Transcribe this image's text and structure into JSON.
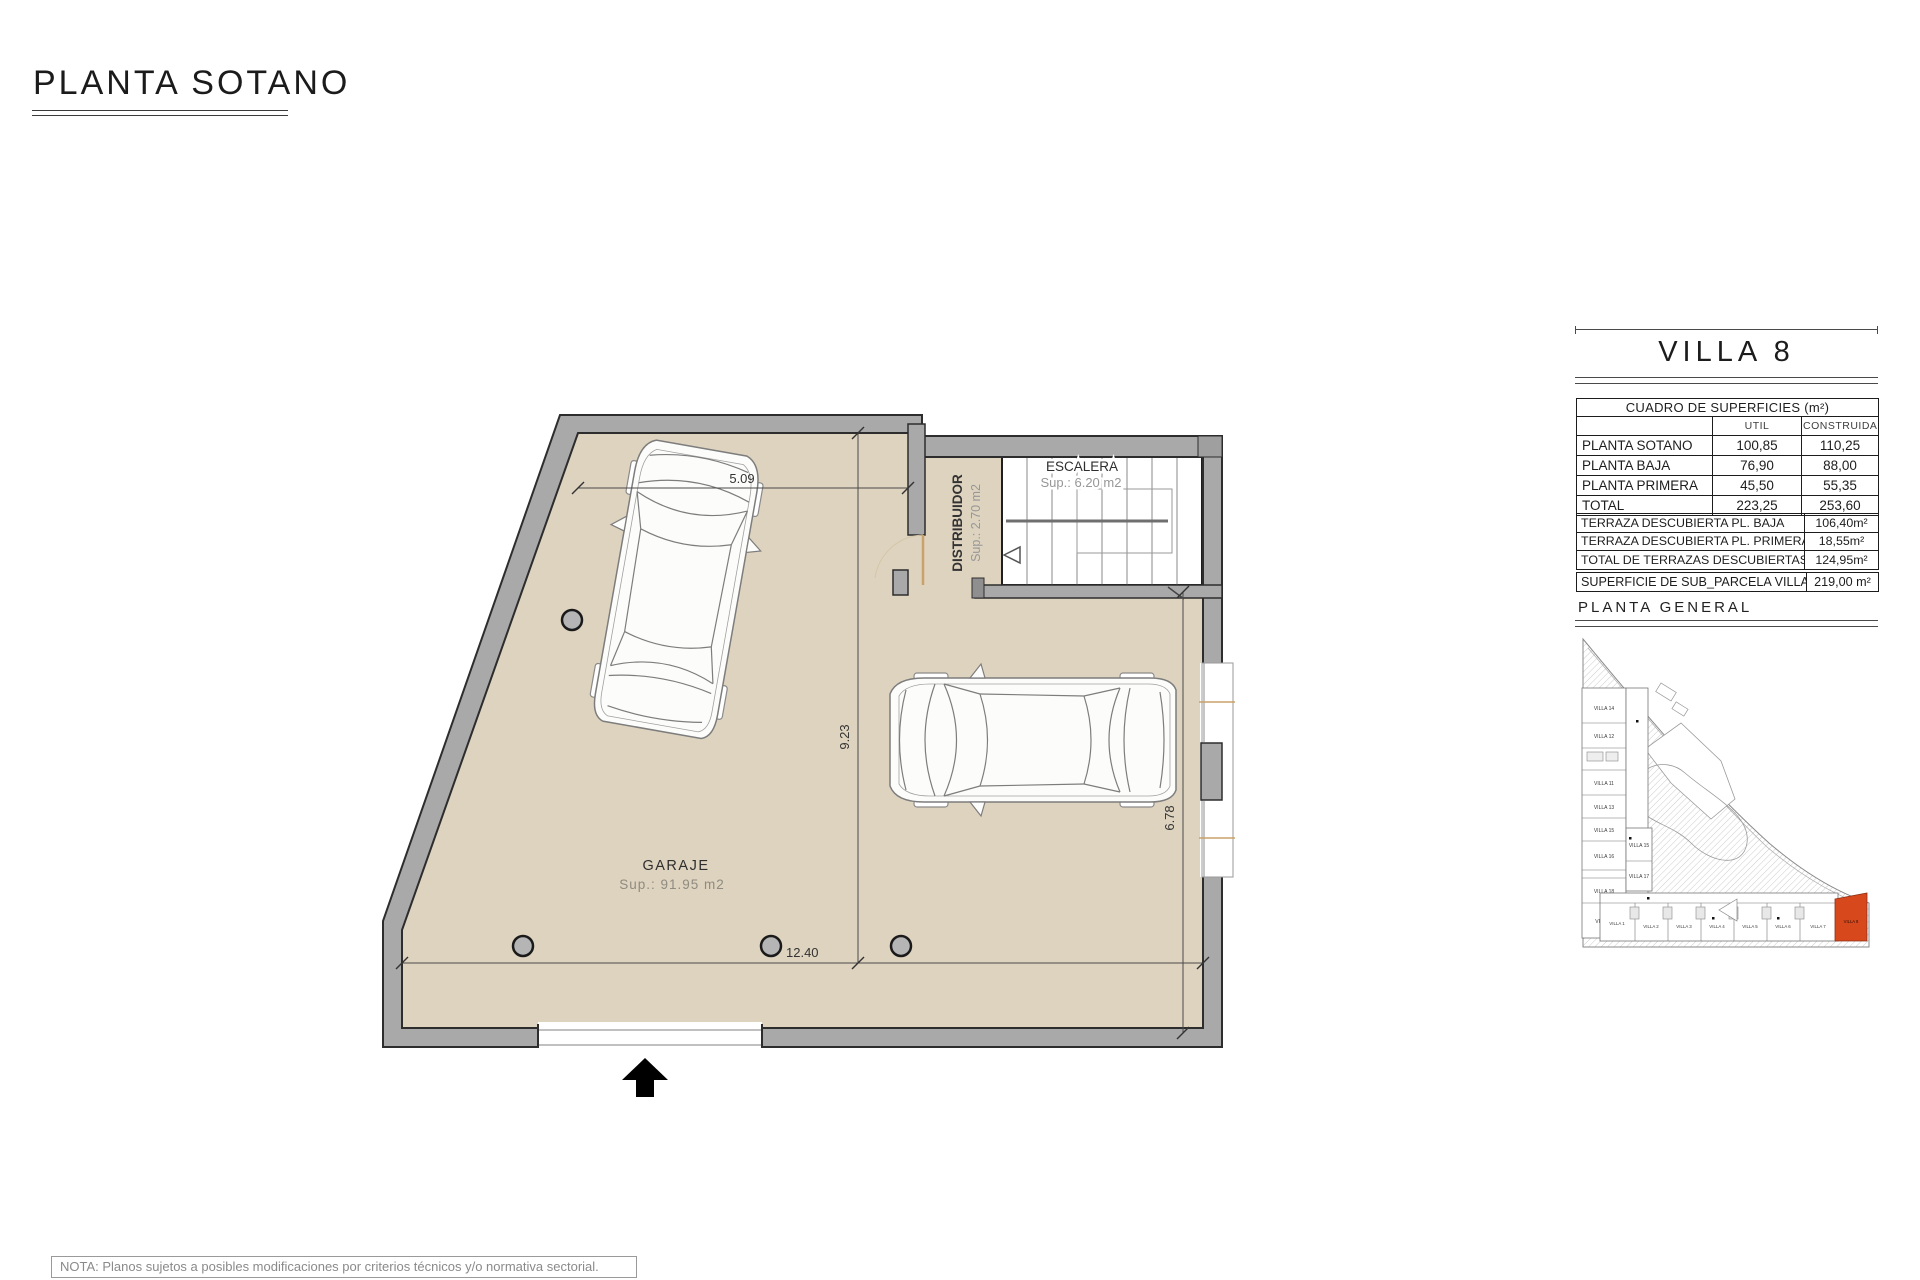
{
  "title": {
    "text": "PLANTA SOTANO"
  },
  "plan": {
    "garaje": {
      "name": "GARAJE",
      "sup": "Sup.: 91.95 m2"
    },
    "escalera": {
      "name": "ESCALERA",
      "sup": "Sup.: 6.20 m2"
    },
    "distribuidor": {
      "name": "DISTRIBUIDOR",
      "sup": "Sup.: 2.70 m2"
    },
    "dims": {
      "top": "5.09",
      "left": "9.23",
      "bottom": "12.40",
      "right": "6.78"
    }
  },
  "panel": {
    "villa": "VILLA 8",
    "cuadro": {
      "title": "CUADRO DE SUPERFICIES (m²)",
      "col_util": "UTIL",
      "col_construida": "CONSTRUIDA",
      "rows": [
        {
          "label": "PLANTA SOTANO",
          "util": "100,85",
          "construida": "110,25"
        },
        {
          "label": "PLANTA BAJA",
          "util": "76,90",
          "construida": "88,00"
        },
        {
          "label": "PLANTA PRIMERA",
          "util": "45,50",
          "construida": "55,35"
        },
        {
          "label": "TOTAL",
          "util": "223,25",
          "construida": "253,60"
        }
      ]
    },
    "terrazas": [
      {
        "label": "TERRAZA DESCUBIERTA PL. BAJA",
        "value": "106,40m²"
      },
      {
        "label": "TERRAZA DESCUBIERTA PL. PRIMERA",
        "value": "18,55m²"
      },
      {
        "label": "TOTAL DE TERRAZAS DESCUBIERTAS",
        "value": "124,95m²"
      }
    ],
    "parcela": {
      "label": "SUPERFICIE DE SUB_PARCELA VILLA 8",
      "value": "219,00 m²"
    },
    "planta_general": "PLANTA GENERAL"
  },
  "site_plan": {
    "left_villas": [
      "VILLA 14",
      "VILLA 12",
      "VILLA 11",
      "VILLA 13",
      "VILLA 15",
      "VILLA 16",
      "VILLA 18",
      "VILLA 9"
    ],
    "middle_villas": [
      "VILLA 15",
      "VILLA 17"
    ],
    "bottom_villas": [
      "VILLA 1",
      "VILLA 2",
      "VILLA 3",
      "VILLA 4",
      "VILLA 5",
      "VILLA 6",
      "VILLA 7"
    ],
    "highlight": "VILLA 8"
  },
  "note": "NOTA: Planos sujetos a posibles modificaciones por criterios técnicos y/o normativa sectorial.",
  "colors": {
    "floor": "#ded3bf",
    "wall": "#a9a9a9",
    "wall_edge": "#2d2d2d",
    "accent": "#c9a268",
    "highlight": "#d8481d"
  }
}
